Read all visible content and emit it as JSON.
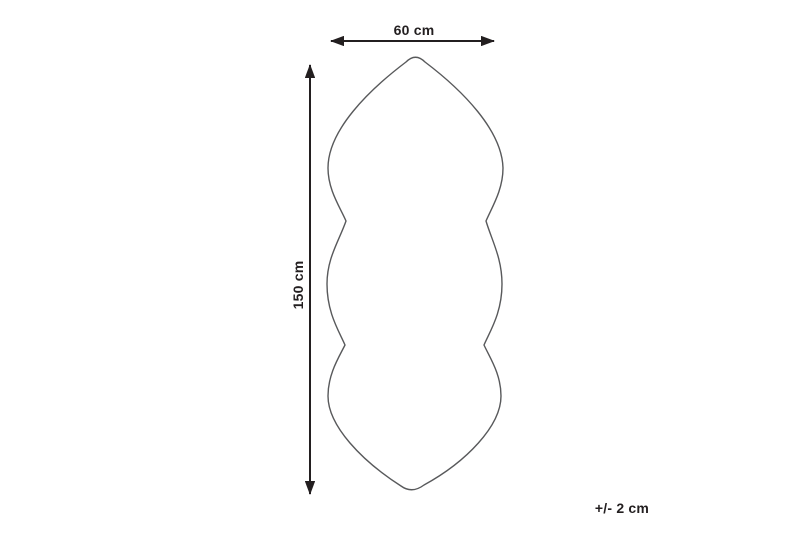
{
  "diagram": {
    "type": "product-dimension-diagram",
    "subject": "shaped rug outline (pointed ends, two side waists)",
    "width_label": "60 cm",
    "height_label": "150 cm",
    "tolerance_label": "+/- 2 cm",
    "colors": {
      "background": "#ffffff",
      "outline": "#58595b",
      "dimension": "#231f20"
    }
  }
}
